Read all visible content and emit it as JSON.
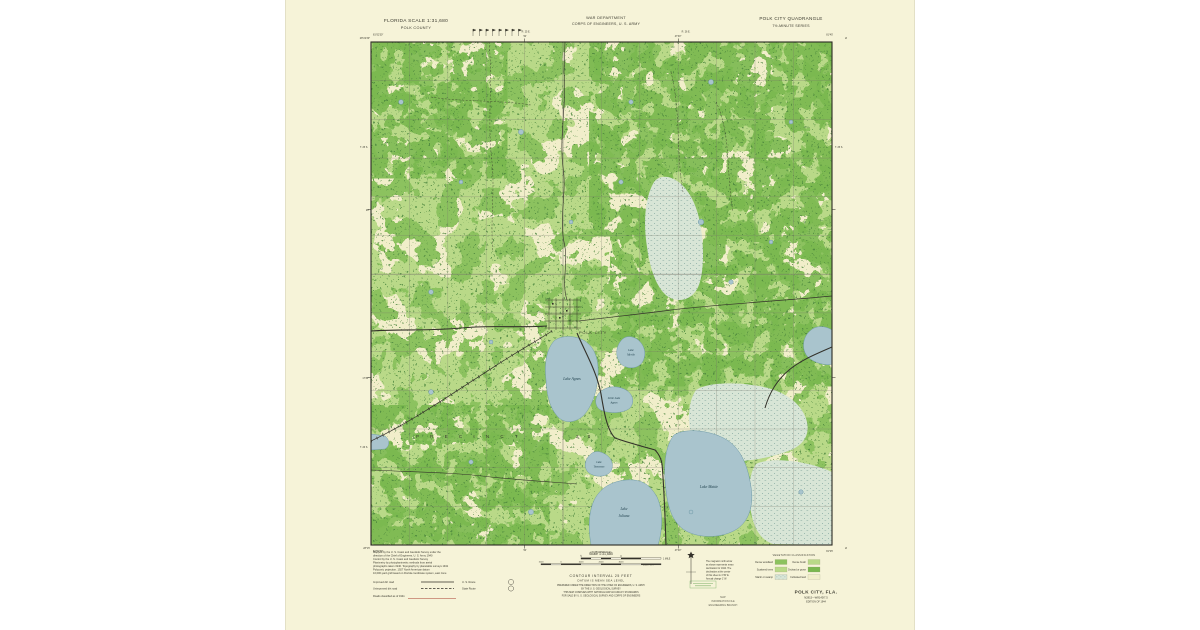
{
  "header": {
    "left1": "FLORIDA SCALE 1:31,680",
    "left2": "POLK COUNTY",
    "center1": "WAR DEPARTMENT",
    "center2": "CORPS OF ENGINEERS, U. S. ARMY",
    "right1": "POLK CITY QUADRANGLE",
    "right2": "7½-MINUTE SERIES"
  },
  "map": {
    "town": "POLK CITY",
    "precinct": "P R E C I N C T",
    "precinct_num": "2 0",
    "lake_agnes": "Lake Agnes",
    "lake_myrtle_1": "Lake",
    "lake_myrtle_2": "Myrtle",
    "little_agnes_1": "Little Lake",
    "little_agnes_2": "Agnes",
    "lake_tennessee_1": "Lake",
    "lake_tennessee_2": "Tennessee",
    "lake_juliana_1": "Lake",
    "lake_juliana_2": "Juliana",
    "lake_mattie": "Lake Mattie"
  },
  "margins": {
    "top_left_lon": "81°52′30″",
    "top_right_lon": "81°45′",
    "top_left_lat": "28°22′30″",
    "top_right_lat": "28°22′30″",
    "bottom_left_lat": "28°15′",
    "bottom_right_lat": "28°15′",
    "bottom_left_lon": "81°52′30″",
    "bottom_right_lon": "81°45′",
    "tick_top_1": "50′",
    "tick_top_2": "47′30″",
    "tick_left_1": "20′",
    "tick_left_2": "17′30″",
    "range_1": "R. 25 E.",
    "range_2": "R. 26 E.",
    "township_1": "T. 25 S.",
    "township_2": "T. 26 S.",
    "adjacent_south": "(AUBURNDALE)"
  },
  "footer": {
    "scale_label": "Scale 1:31,680",
    "miles": [
      "½",
      "0",
      "1 MILE"
    ],
    "feet": [
      "1000",
      "0",
      "1000",
      "2000",
      "3000",
      "4000 FEET"
    ],
    "contour": "CONTOUR INTERVAL 25 FEET",
    "datum": "DATUM IS MEAN SEA LEVEL",
    "notes": [
      "PREPARED UNDER THE DIRECTION OF THE CHIEF OF ENGINEERS, U. S. ARMY",
      "BY THE U. S. GEOLOGICAL SURVEY",
      "THIS MAP COMPLIES WITH NATIONAL MAP ACCURACY STANDARDS",
      "FOR SALE BY U. S. GEOLOGICAL SURVEY AND CORPS OF ENGINEERS"
    ],
    "credits": [
      "Mapped by the U. S. Coast and Geodetic Survey under the",
      "direction of the Chief of Engineers, U. S. Army 1940",
      "Control by the U. S. Coast and Geodetic Survey",
      "Planimetry by photoplanimetric methods from aerial",
      "photographs taken 1940. Topography by planetable surveys 1941",
      "Polyconic projection. 1927 North American datum",
      "10,000-yard grid based on Florida coordinate system, east zone"
    ],
    "road_rows": [
      "Improved dirt road",
      "Unimproved dirt road"
    ],
    "route_labels": [
      "U. S. Route",
      "State Route"
    ],
    "road_note": "Roads classified as of 1941",
    "declination": [
      "The magnetic north arrow",
      "as shown represents mean",
      "declination for 1944. The",
      "declination at the center",
      "of this sheet is 1°30′ E.",
      "Annual change 1′ W."
    ],
    "legend_title": "VEGETATION CLASSIFICATION",
    "legend_rows": [
      {
        "l": "Dense woodland",
        "r": "Dense brush"
      },
      {
        "l": "Scattered trees",
        "r": "Orchard or grove"
      },
      {
        "l": "Marsh or swamp",
        "r": "Cultivated land"
      }
    ],
    "title": "POLK CITY, FLA.",
    "subtitle": "N2815—W8145/7.5",
    "edition": "EDITION OF 1944",
    "stamp": [
      "MAP",
      "INFORMATION FILE",
      "ENGINEERING BRANCH"
    ]
  },
  "colors": {
    "paper": "#f6f3d8",
    "map_base": "#f1eeca",
    "veg_light": "#b9d988",
    "veg_mid": "#8cc25e",
    "veg_dense": "#7ab84f",
    "veg_dot": "#47823a",
    "water": "#a9c4cd",
    "water_edge": "#6e9aa8",
    "marsh": "#d8e5d6",
    "frame": "#2a2a24",
    "stamp_green": "#5a9e4a"
  }
}
